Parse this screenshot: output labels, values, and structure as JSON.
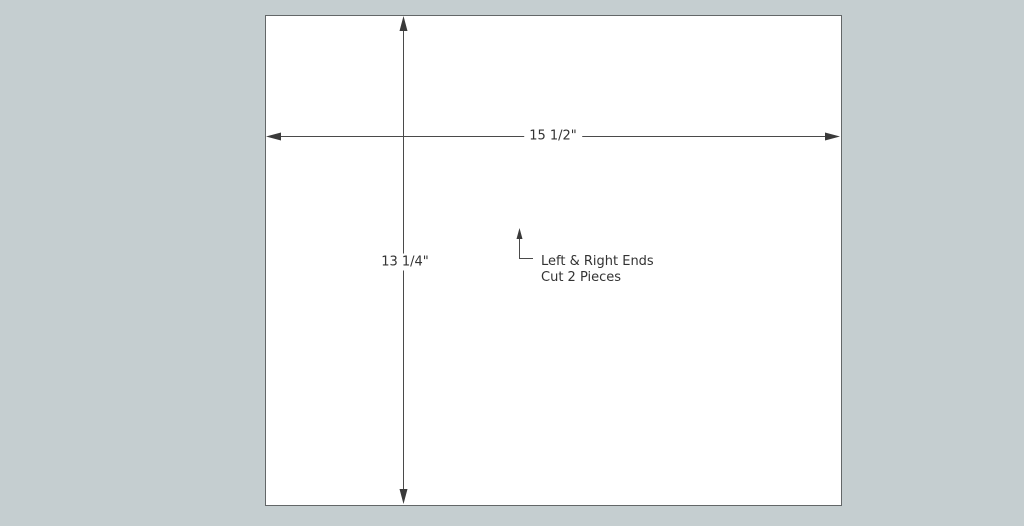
{
  "scene": {
    "background_color": "#c5ced0",
    "panel_fill": "#ffffff",
    "line_color": "#4a4a4a",
    "text_color": "#333333"
  },
  "panel": {
    "width_dimension": "15 1/2\"",
    "height_dimension": "13 1/4\""
  },
  "callout": {
    "line1": "Left & Right Ends",
    "line2": "Cut 2 Pieces"
  }
}
